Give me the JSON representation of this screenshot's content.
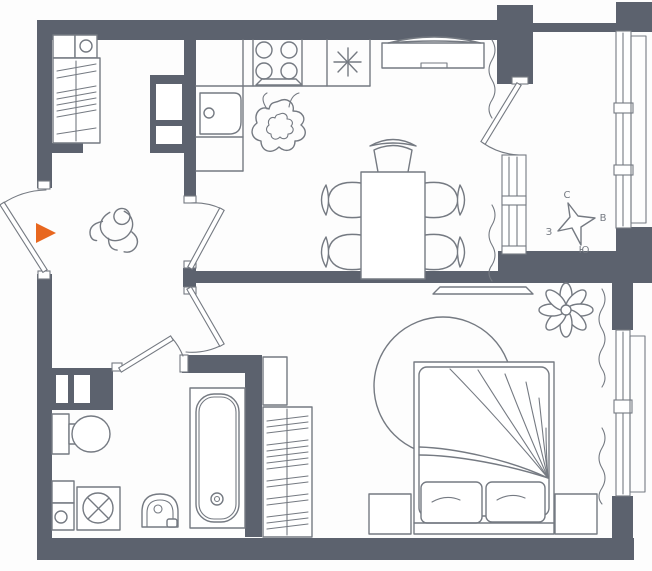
{
  "colors": {
    "wall": "#5c626e",
    "line": "#757a82",
    "accent_orange": "#e8671f",
    "bg": "#fdfdfd"
  },
  "compass": {
    "north_label": "С",
    "east_label": "В",
    "south_label": "Ю",
    "west_label": "З"
  },
  "entrance": {
    "marker": "orange-right-triangle"
  }
}
